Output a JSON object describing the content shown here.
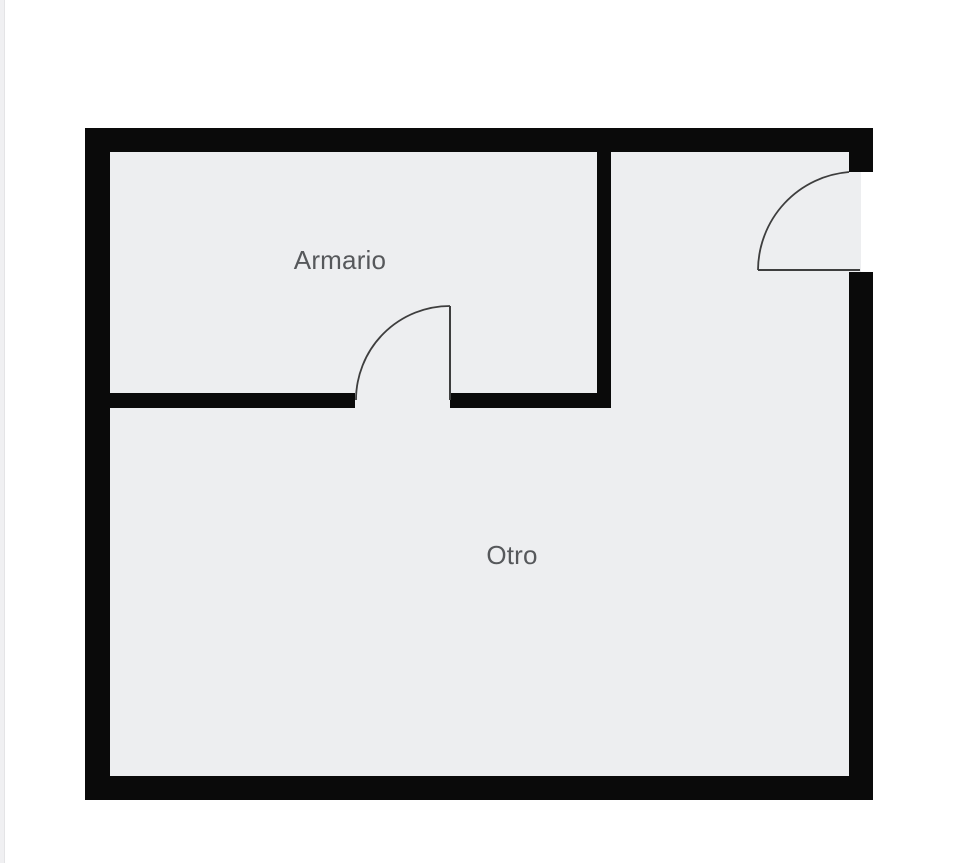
{
  "plan": {
    "type": "floorplan",
    "rooms": [
      {
        "id": "armario",
        "label": "Armario"
      },
      {
        "id": "otro",
        "label": "Otro"
      }
    ],
    "doors": [
      {
        "id": "door-interior",
        "location": "between Armario and Otro, divider wall"
      },
      {
        "id": "door-exterior",
        "location": "right exterior wall, upper section"
      }
    ]
  },
  "colors": {
    "background": "#ffffff",
    "floor": "#edeef0",
    "wall": "#0a0a0a",
    "door_line": "#3e3e3e",
    "label_text": "#56585b",
    "page_edge": "#f0f0f2"
  }
}
